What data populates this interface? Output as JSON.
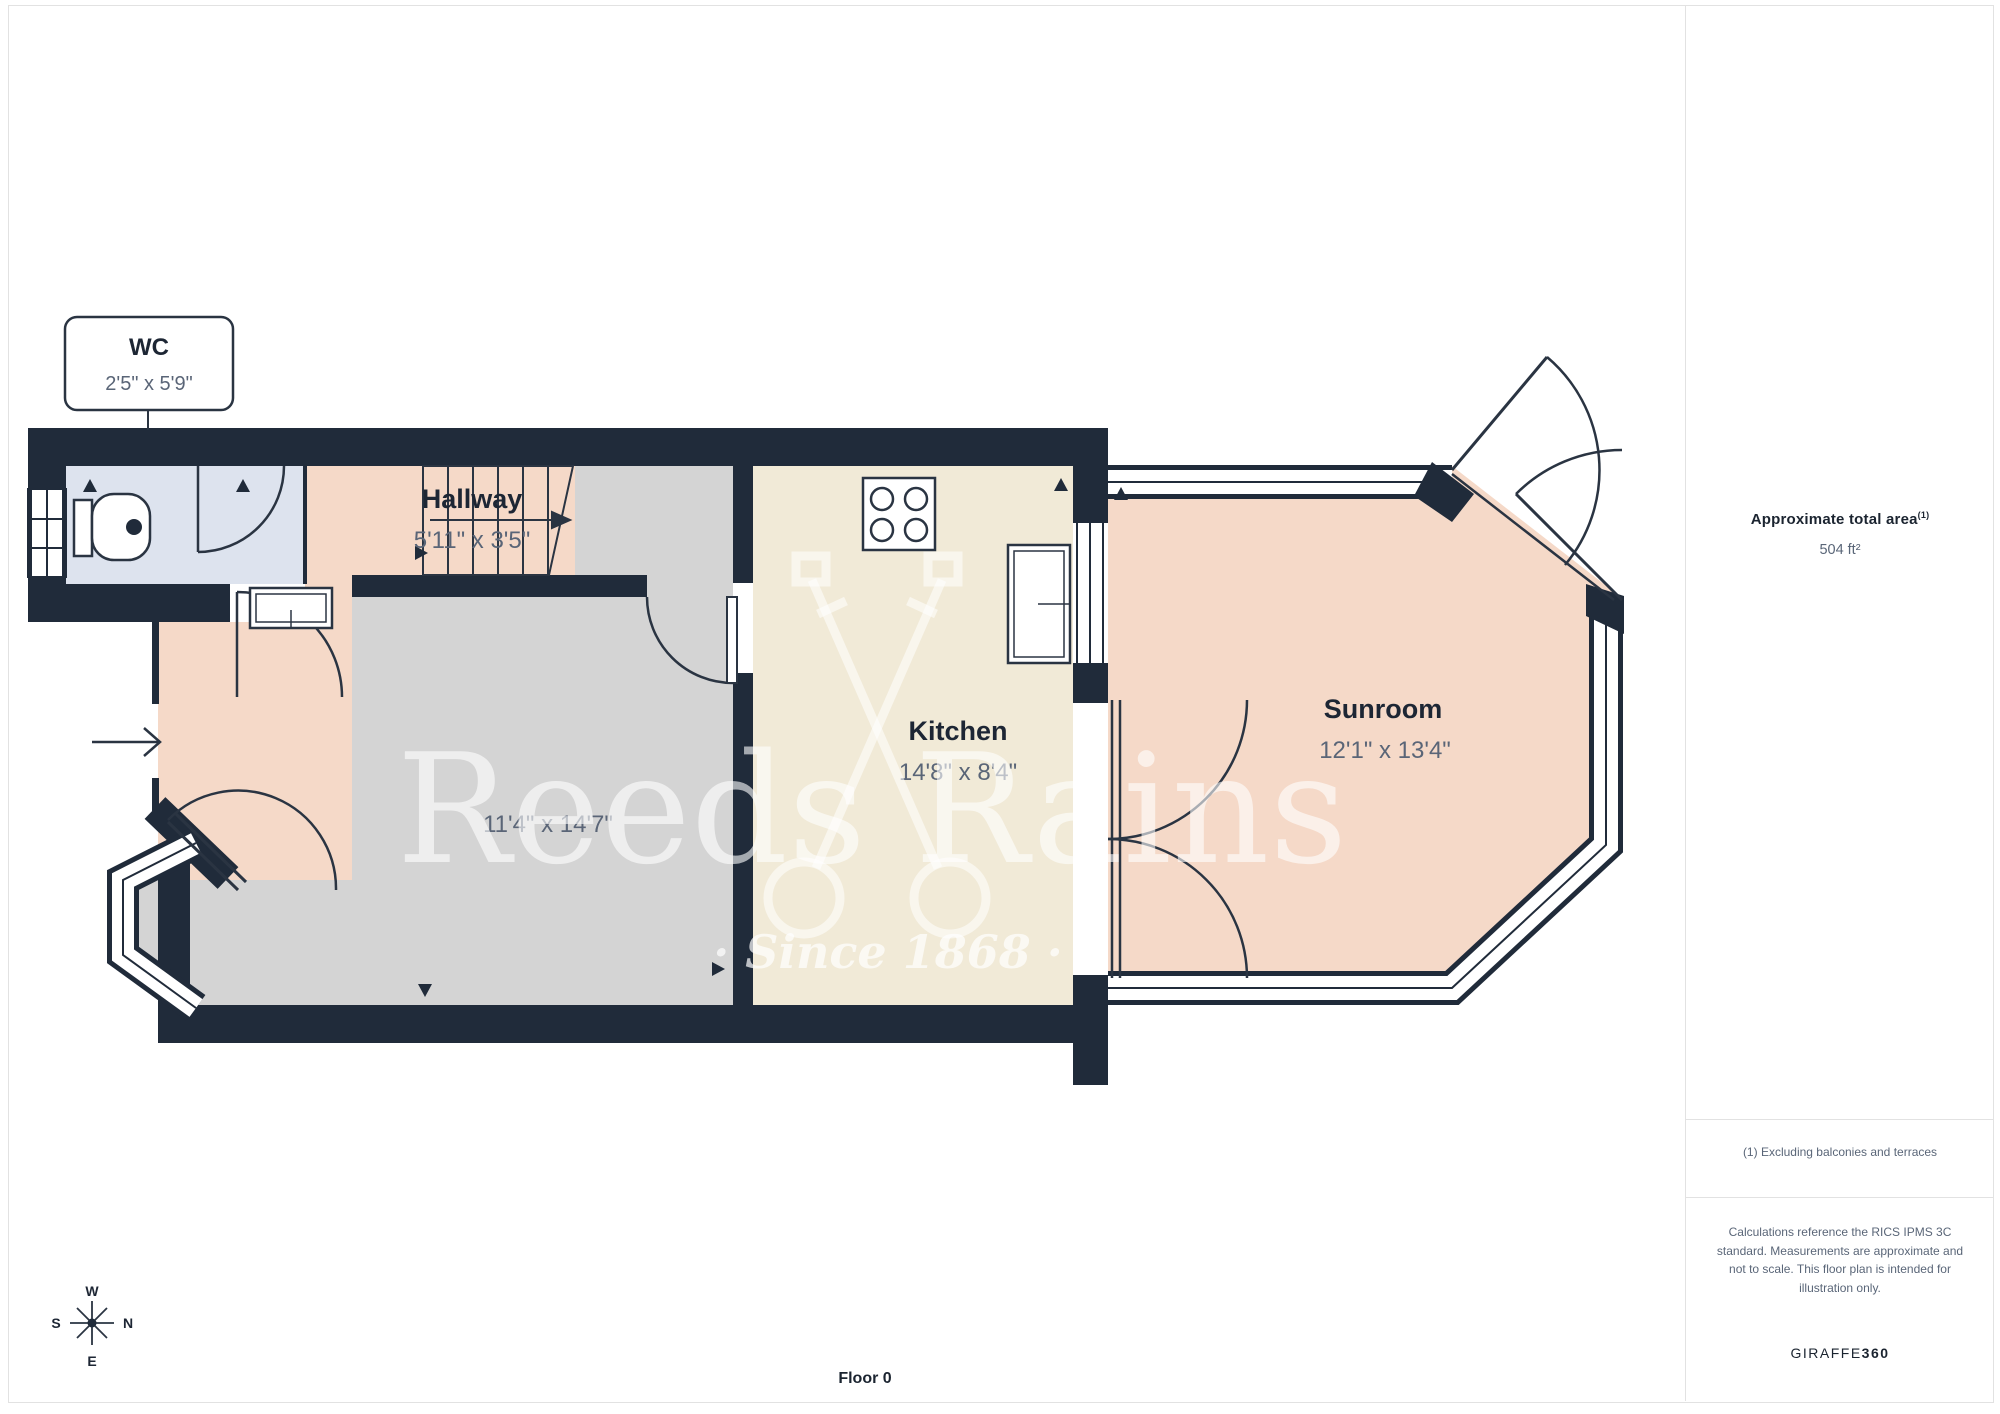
{
  "page": {
    "floor_label": "Floor 0"
  },
  "watermark": {
    "brand": "Reeds Rains",
    "tagline": "· Since 1868 ·"
  },
  "callout": {
    "room": "WC",
    "dims": "2'5\" x 5'9\""
  },
  "rooms": {
    "hallway": {
      "name": "Hallway",
      "dims": "5'11\" x 3'5\""
    },
    "living": {
      "dims": "11'4\" x 14'7\""
    },
    "kitchen": {
      "name": "Kitchen",
      "dims": "14'8\" x 8'4\""
    },
    "sunroom": {
      "name": "Sunroom",
      "dims": "12'1\" x 13'4\""
    }
  },
  "compass": {
    "n": "N",
    "s": "S",
    "e": "E",
    "w": "W"
  },
  "sidebar": {
    "area_title": "Approximate total area",
    "area_superscript": "(1)",
    "area_value": "504 ft²",
    "footnote": "(1) Excluding balconies and terraces",
    "disclaimer": "Calculations reference the RICS IPMS 3C standard. Measurements are approximate and not to scale. This floor plan is intended for illustration only.",
    "brand_normal": "GIRAFFE",
    "brand_bold": "360"
  },
  "colors": {
    "wall": "#202b3a",
    "wc_fill": "#dde3ee",
    "hall_sunroom_fill": "#f5d9c8",
    "living_fill": "#d4d4d4",
    "kitchen_fill": "#f1ead7",
    "dim_text": "#5a6577",
    "dark_text": "#1d2634",
    "divider": "#e2e2e2"
  }
}
